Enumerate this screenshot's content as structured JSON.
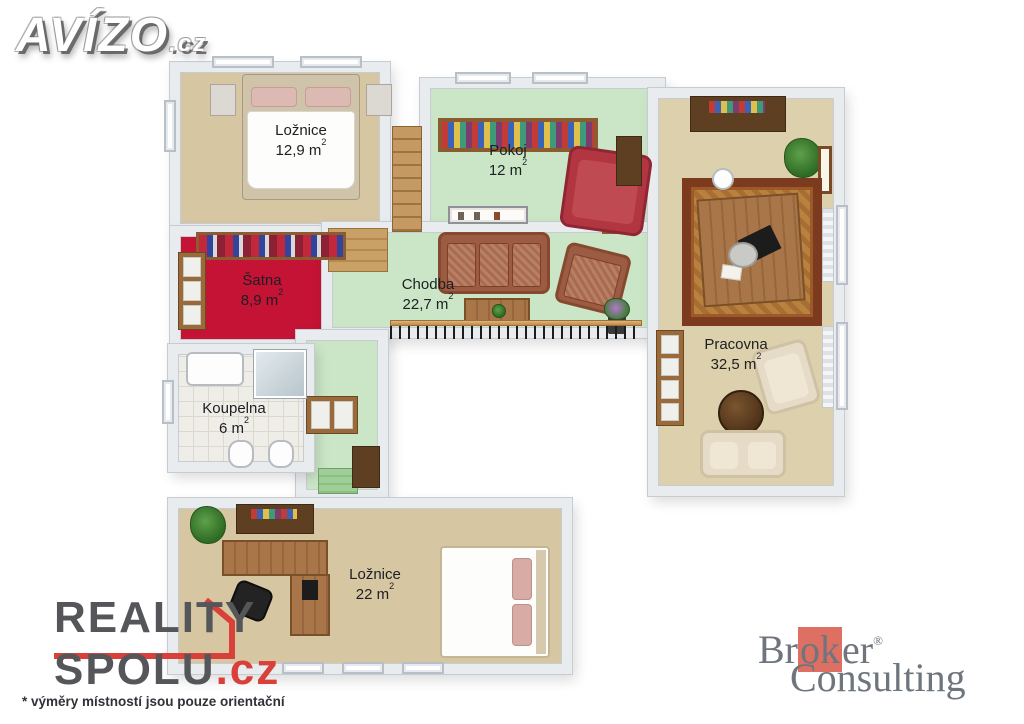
{
  "branding": {
    "avizo": {
      "name": "AVÍZO",
      "tld": ".cz"
    },
    "reality_spolu": {
      "line1": "REALITY",
      "line2": "SPOLU",
      "tld": ".cz"
    },
    "broker_consulting": {
      "part1": "Br",
      "part_red": "ok",
      "part2": "er",
      "reg": "®",
      "line2": "Consulting"
    },
    "footnote": "* výměry místností jsou pouze orientační"
  },
  "rooms": [
    {
      "id": "loznice-horni",
      "name": "Ložnice",
      "area": "12,9 m",
      "area_sup": "2"
    },
    {
      "id": "pokoj",
      "name": "Pokoj",
      "area": "12 m",
      "area_sup": "2"
    },
    {
      "id": "satna",
      "name": "Šatna",
      "area": "8,9 m",
      "area_sup": "2"
    },
    {
      "id": "chodba",
      "name": "Chodba",
      "area": "22,7 m",
      "area_sup": "2"
    },
    {
      "id": "koupelna",
      "name": "Koupelna",
      "area": "6 m",
      "area_sup": "2"
    },
    {
      "id": "pracovna",
      "name": "Pracovna",
      "area": "32,5 m",
      "area_sup": "2"
    },
    {
      "id": "loznice-dolni",
      "name": "Ložnice",
      "area": "22 m",
      "area_sup": "2"
    }
  ],
  "colors": {
    "floor_beige": "#d7c6a2",
    "floor_sand": "#ddd0ac",
    "floor_green": "#cbe6c7",
    "carpet_red": "#c41334",
    "floor_tile": "#efede8",
    "wall": "#e9ecef",
    "railing_wood": "#cf9a5d",
    "reality_spolu_red": "#d9403a",
    "broker_red": "#dd6f63"
  }
}
